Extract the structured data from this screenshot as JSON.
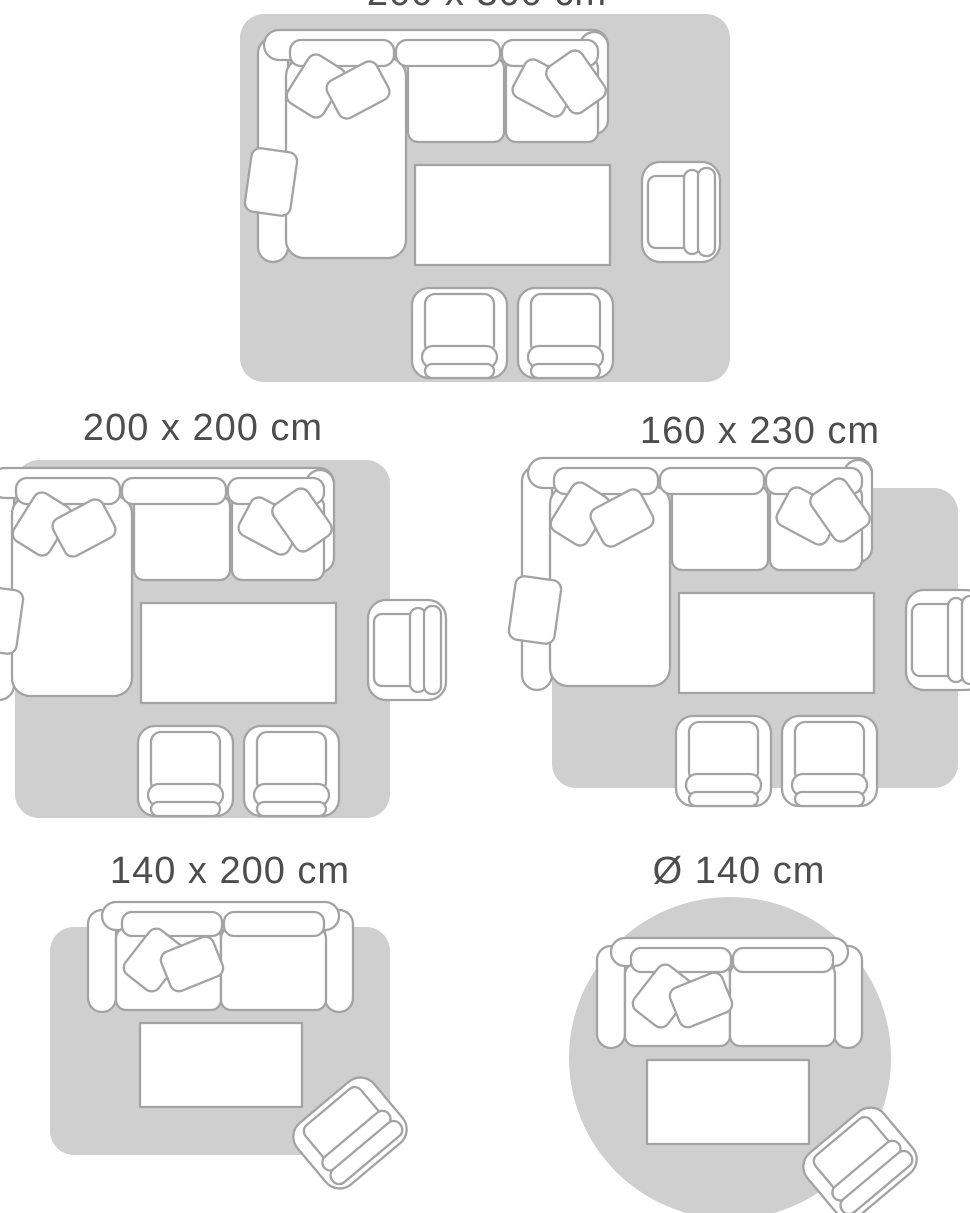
{
  "colors": {
    "rug": "#cfcfcf",
    "furniture_fill": "#ffffff",
    "furniture_outline": "#a3a3a3",
    "label_text": "#4d4d4d",
    "page_bg": "#ffffff"
  },
  "panels": [
    {
      "id": "size-200x300",
      "label": "200 x 300 cm",
      "rug_shape": "rectangle"
    },
    {
      "id": "size-200x200",
      "label": "200 x 200 cm",
      "rug_shape": "rectangle"
    },
    {
      "id": "size-160x230",
      "label": "160 x 230 cm",
      "rug_shape": "rectangle"
    },
    {
      "id": "size-140x200",
      "label": "140 x 200 cm",
      "rug_shape": "rectangle"
    },
    {
      "id": "size-d140",
      "label": "Ø 140 cm",
      "rug_shape": "circle"
    }
  ]
}
